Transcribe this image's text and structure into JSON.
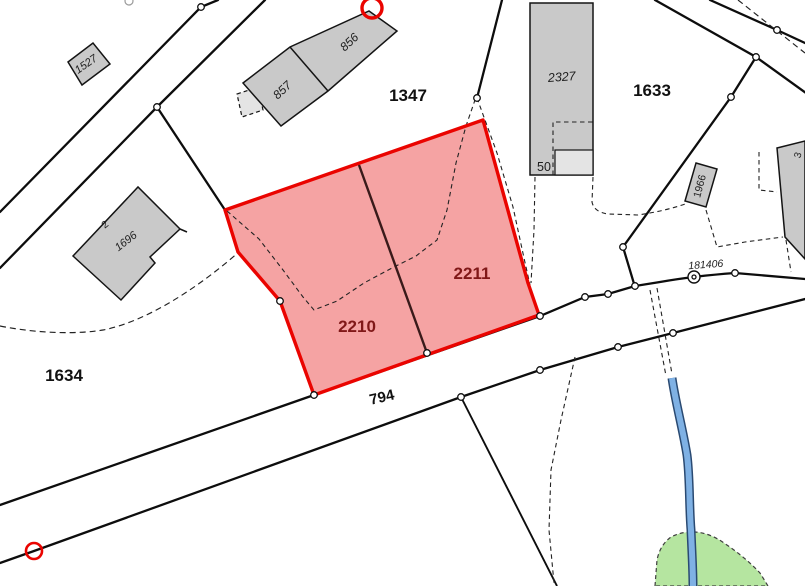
{
  "title": "Cadastral parcel map",
  "colors": {
    "background": "#ffffff",
    "highlight_fill": "#f5a3a3",
    "highlight_border": "#ea0400",
    "highlight_label": "#801818",
    "building_fill": "#c9c9c9",
    "building_fill_light": "#e4e4e4",
    "line": "#0d0d0d",
    "stream_fill": "#7fb1e4",
    "stream_casing": "#2a4a72",
    "green_area_fill": "#b5e5a0",
    "marker_red": "#ea0400"
  },
  "highlighted_parcel_ids": [
    "2210",
    "2211"
  ],
  "parcels": {
    "p1347": "1347",
    "p1633": "1633",
    "p1634": "1634",
    "p2210": "2210",
    "p2211": "2211"
  },
  "roads": {
    "r794": "794",
    "r181406": "181406"
  },
  "buildings": {
    "b1527": "1527",
    "b857": "857",
    "b856": "856",
    "b2327": "2327",
    "b50": "50",
    "b1696": "1696",
    "b2": "2",
    "b1966": "1966",
    "b3": "3"
  }
}
